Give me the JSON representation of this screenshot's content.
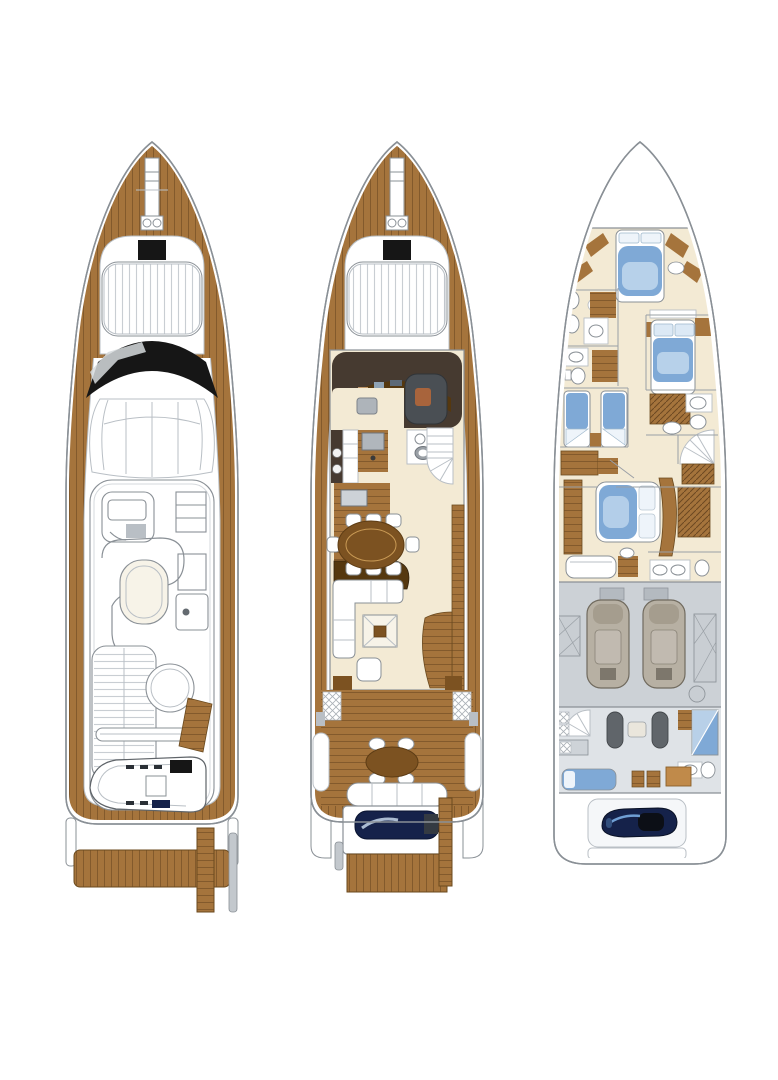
{
  "figure": {
    "kind": "yacht general arrangement plan",
    "views": 3,
    "background": "#ffffff"
  },
  "colors": {
    "outline": "#8a9096",
    "line_light": "#b9bfc5",
    "teak": "#a5743c",
    "teak_dark": "#7c5221",
    "teak_deep": "#55380f",
    "espresso": "#463a30",
    "black": "#161616",
    "cream": "#f3ead4",
    "bed_blue": "#7fa9d6",
    "bed_blue_light": "#cfe2f2",
    "navy": "#15224a",
    "gray_floor": "#ccd1d6",
    "gray_floor_light": "#dfe3e7",
    "seat_gray": "#4a4f54",
    "steel": "#b9bfc5",
    "white": "#ffffff"
  },
  "decks": [
    {
      "id": "flybridge-deck",
      "label": "Flybridge and sun deck plan",
      "features": [
        "bow pulpit",
        "anchor windlass",
        "foredeck sun pad",
        "black windscreen",
        "hardtop cowling",
        "helm seating module",
        "wet bar units",
        "curved lounge with table",
        "aft sun pad",
        "round table",
        "tender crane",
        "tender with outboard engine",
        "flybridge stairs",
        "swim platform",
        "passerelle"
      ]
    },
    {
      "id": "main-deck",
      "label": "Main deck plan",
      "features": [
        "anchor windlass",
        "foredeck sun pad",
        "helm station with companion seat",
        "galley with stove and sink",
        "day head",
        "staircase to flybridge",
        "oval dining table with eight chairs",
        "companionway stairs to lower deck",
        "L-shaped sofa",
        "coffee table",
        "armchair",
        "aft cockpit with round table and bench",
        "transom garage with jet tender",
        "teak swim platform"
      ]
    },
    {
      "id": "lower-deck",
      "label": "Lower deck plan",
      "features": [
        "forward VIP cabin with double bed",
        "VIP bathroom",
        "port guest bathroom",
        "port twin guest cabin",
        "starboard guest double cabin",
        "starboard guest bathroom",
        "main staircase",
        "full-beam master cabin with double bed",
        "master sofa and vanity",
        "master bathroom",
        "engine room with twin engines",
        "crew quarters with dinette",
        "crew bathroom with shower",
        "crew bunk",
        "stern garage with jet ski",
        "stern platform"
      ]
    }
  ]
}
